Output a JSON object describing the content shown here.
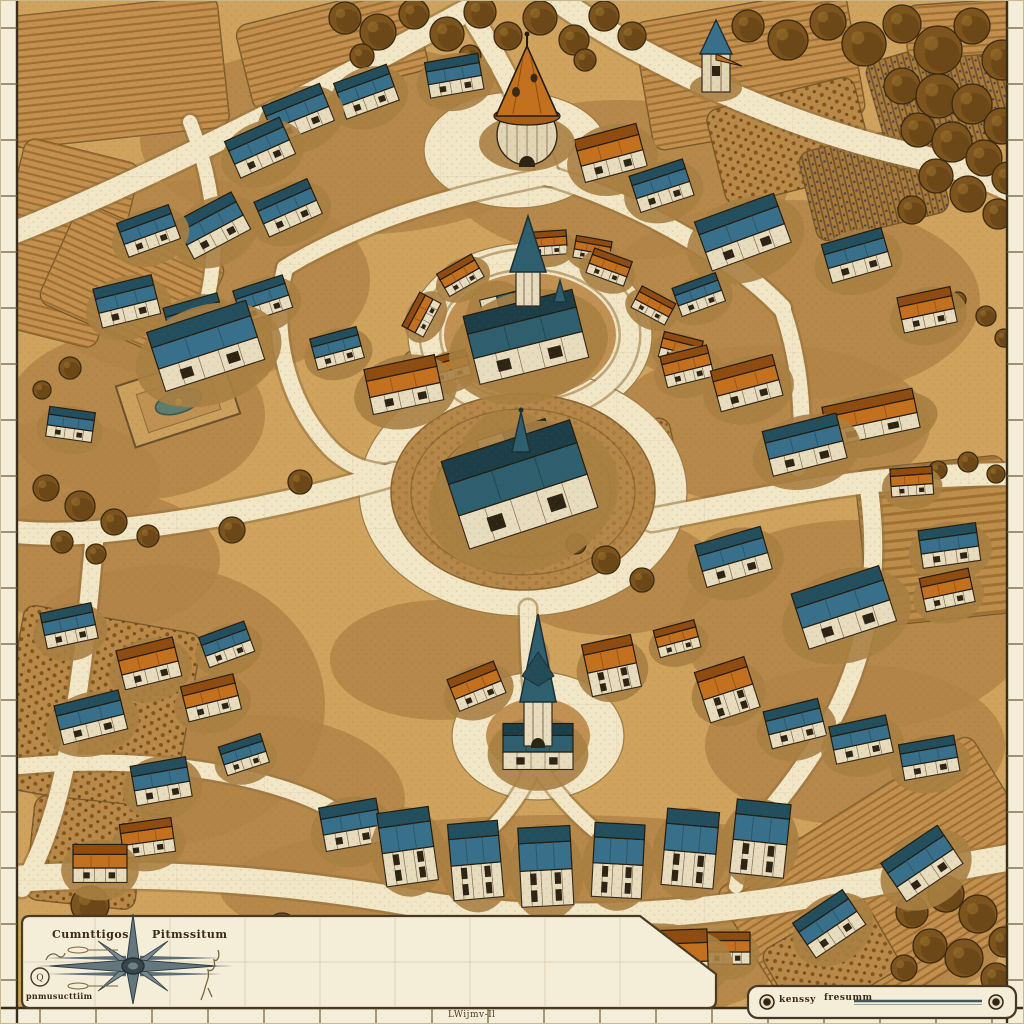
{
  "title": "hand-drawn isometric village map",
  "palette": {
    "parchment_road": "#f1e6c6",
    "ground": "#cfa35e",
    "scrub": "#b18446",
    "field_base": "#c49050",
    "margin_strip": "#f4edd8",
    "ink": "#33281a",
    "roof_blue": "#38708c",
    "roof_blue_dark": "#234e5e",
    "roof_teal": "#2e5f6f",
    "roof_orange": "#c4711f",
    "roof_orange_dark": "#8f4c10",
    "wall": "#e7dcbe",
    "tree": "#7d541d",
    "compass_steel": "#64777f"
  },
  "compass_panel": {
    "label_left": "Cumnttigos",
    "label_right": "Pitmssitum",
    "label_small": "pnmusucttiim",
    "badge": "Q"
  },
  "scale_panel": {
    "label_start": "kenssy",
    "label_mid": "fresumm"
  },
  "margins": {
    "bottom_label": "LWijmv-Il"
  },
  "scene": {
    "scrub": [
      [
        350,
        140,
        210,
        95
      ],
      [
        200,
        280,
        170,
        100
      ],
      [
        135,
        415,
        130,
        85
      ],
      [
        620,
        180,
        170,
        80
      ],
      [
        790,
        300,
        190,
        100
      ],
      [
        770,
        425,
        160,
        80
      ],
      [
        855,
        625,
        175,
        105
      ],
      [
        855,
        745,
        150,
        80
      ],
      [
        160,
        705,
        165,
        140
      ],
      [
        255,
        800,
        150,
        85
      ],
      [
        100,
        560,
        120,
        70
      ],
      [
        560,
        890,
        340,
        75
      ],
      [
        520,
        975,
        250,
        55
      ],
      [
        610,
        575,
        110,
        60
      ],
      [
        440,
        660,
        110,
        60
      ],
      [
        880,
        925,
        130,
        80
      ],
      [
        60,
        480,
        100,
        60
      ]
    ],
    "fields": [
      [
        6,
        6,
        218,
        132,
        -6,
        "furrow"
      ],
      [
        242,
        4,
        180,
        88,
        -14,
        "furrow"
      ],
      [
        2,
        148,
        118,
        190,
        14,
        "furrow"
      ],
      [
        52,
        228,
        160,
        110,
        24,
        "furrow"
      ],
      [
        642,
        4,
        215,
        130,
        -10,
        "furrow"
      ],
      [
        714,
        92,
        152,
        98,
        -14,
        "crops"
      ],
      [
        806,
        136,
        136,
        92,
        -14,
        "vine"
      ],
      [
        876,
        42,
        148,
        112,
        -16,
        "vine"
      ],
      [
        906,
        2,
        112,
        54,
        -4,
        "furrow"
      ],
      [
        862,
        462,
        150,
        158,
        -6,
        "rows"
      ],
      [
        742,
        798,
        300,
        190,
        -32,
        "furrow"
      ],
      [
        772,
        918,
        118,
        84,
        -30,
        "crops"
      ],
      [
        8,
        618,
        180,
        185,
        10,
        "crops"
      ],
      [
        30,
        800,
        110,
        105,
        6,
        "crops"
      ],
      [
        398,
        358,
        66,
        40,
        24,
        "red"
      ],
      [
        592,
        424,
        82,
        52,
        -12,
        "red"
      ]
    ],
    "plazas": [
      [
        516,
        150,
        92,
        58
      ],
      [
        530,
        335,
        122,
        92
      ],
      [
        523,
        492,
        164,
        124
      ],
      [
        538,
        736,
        86,
        64
      ]
    ],
    "inners": [
      [
        530,
        335,
        86,
        62
      ],
      [
        538,
        736,
        52,
        38
      ]
    ],
    "central_plaza": {
      "x": 523,
      "y": 492,
      "rx": 132,
      "ry": 98,
      "rings": [
        112,
        88,
        66
      ]
    },
    "roads": [
      [
        "M0,238 C120,192 300,102 468,10",
        22
      ],
      [
        "M468,10 C505,68 532,125 549,176",
        20
      ],
      [
        "M558,0 C652,66 790,128 915,156 C962,167 998,182 1024,196",
        24
      ],
      [
        "M549,176 C480,190 420,205 372,225 C340,238 310,252 285,268",
        16
      ],
      [
        "M549,176 C600,192 650,215 695,242 C730,262 760,285 782,308",
        18
      ],
      [
        "M285,268 C270,330 285,400 330,448 C352,470 374,472 394,474",
        16
      ],
      [
        "M531,254 C531,278 531,298 531,314",
        14
      ],
      [
        "M430,335 a100,76 0 1 0 200,0 a100,76 0 1 0 -200,0",
        18
      ],
      [
        "M531,410 L529,434",
        16
      ],
      [
        "M394,474 C300,502 200,522 95,532 C60,535 25,534 0,530",
        22
      ],
      [
        "M652,520 C730,505 800,490 868,482 C920,476 975,474 1024,474",
        22
      ],
      [
        "M528,608 C528,650 530,676 533,698",
        16
      ],
      [
        "M533,766 C520,800 495,830 462,852",
        14
      ],
      [
        "M538,766 C560,800 590,830 622,850",
        14
      ],
      [
        "M0,880 C150,868 300,882 420,904 C540,925 680,918 810,895 C890,880 970,864 1024,855",
        26
      ],
      [
        "M95,532 C88,610 82,690 62,780 C52,824 38,860 22,888",
        18
      ],
      [
        "M782,308 C800,360 806,420 798,468",
        16
      ],
      [
        "M868,482 C880,560 872,640 836,712 C815,754 788,790 762,820",
        18
      ],
      [
        "M762,820 C748,846 740,866 736,886",
        14
      ],
      [
        "M190,122 C218,192 222,262 198,332",
        14
      ],
      [
        "M0,768 C90,758 180,762 252,780 C300,792 332,806 354,824",
        16
      ]
    ],
    "trees": [
      [
        345,
        18,
        16
      ],
      [
        378,
        32,
        18
      ],
      [
        414,
        14,
        15
      ],
      [
        447,
        34,
        17
      ],
      [
        480,
        12,
        16
      ],
      [
        508,
        36,
        14
      ],
      [
        540,
        18,
        17
      ],
      [
        574,
        40,
        15
      ],
      [
        604,
        16,
        15
      ],
      [
        632,
        36,
        14
      ],
      [
        362,
        56,
        12
      ],
      [
        470,
        56,
        11
      ],
      [
        585,
        60,
        11
      ],
      [
        748,
        26,
        16
      ],
      [
        788,
        40,
        20
      ],
      [
        828,
        22,
        18
      ],
      [
        864,
        44,
        22
      ],
      [
        902,
        24,
        19
      ],
      [
        938,
        50,
        24
      ],
      [
        972,
        26,
        18
      ],
      [
        1002,
        60,
        20
      ],
      [
        902,
        86,
        18
      ],
      [
        938,
        96,
        22
      ],
      [
        972,
        104,
        20
      ],
      [
        1002,
        126,
        18
      ],
      [
        918,
        130,
        17
      ],
      [
        952,
        142,
        20
      ],
      [
        984,
        158,
        18
      ],
      [
        1008,
        178,
        16
      ],
      [
        936,
        176,
        17
      ],
      [
        968,
        194,
        18
      ],
      [
        998,
        214,
        15
      ],
      [
        912,
        210,
        14
      ],
      [
        986,
        316,
        10
      ],
      [
        1004,
        338,
        9
      ],
      [
        958,
        300,
        8
      ],
      [
        938,
        470,
        9
      ],
      [
        968,
        462,
        10
      ],
      [
        996,
        474,
        9
      ],
      [
        912,
        912,
        16
      ],
      [
        946,
        894,
        18
      ],
      [
        978,
        914,
        19
      ],
      [
        1004,
        942,
        15
      ],
      [
        930,
        946,
        17
      ],
      [
        964,
        958,
        19
      ],
      [
        996,
        978,
        15
      ],
      [
        904,
        968,
        13
      ],
      [
        232,
        530,
        13
      ],
      [
        300,
        482,
        12
      ],
      [
        90,
        905,
        19
      ],
      [
        282,
        928,
        15
      ],
      [
        606,
        560,
        14
      ],
      [
        642,
        580,
        12
      ],
      [
        576,
        544,
        10
      ],
      [
        46,
        488,
        13
      ],
      [
        80,
        506,
        15
      ],
      [
        114,
        522,
        13
      ],
      [
        148,
        536,
        11
      ],
      [
        62,
        542,
        11
      ],
      [
        96,
        554,
        10
      ],
      [
        70,
        368,
        11
      ],
      [
        42,
        390,
        9
      ]
    ],
    "houses": [
      [
        300,
        118,
        -22,
        62,
        40,
        "b",
        0
      ],
      [
        368,
        96,
        -20,
        56,
        38,
        "b",
        0
      ],
      [
        455,
        80,
        -10,
        54,
        36,
        "b",
        0
      ],
      [
        262,
        152,
        -24,
        60,
        40,
        "b",
        0
      ],
      [
        215,
        230,
        -28,
        64,
        42,
        "b",
        0
      ],
      [
        290,
        212,
        -24,
        58,
        38,
        "b",
        0
      ],
      [
        150,
        235,
        -20,
        55,
        36,
        "b",
        0
      ],
      [
        128,
        306,
        -14,
        60,
        40,
        "b",
        0
      ],
      [
        196,
        322,
        -16,
        56,
        36,
        "b",
        0
      ],
      [
        264,
        303,
        -18,
        52,
        34,
        "b",
        0
      ],
      [
        338,
        352,
        -15,
        48,
        32,
        "b",
        0
      ],
      [
        70,
        428,
        8,
        46,
        30,
        "b",
        0
      ],
      [
        405,
        390,
        -12,
        72,
        46,
        "o",
        0
      ],
      [
        612,
        158,
        -15,
        64,
        44,
        "o",
        0
      ],
      [
        663,
        190,
        -18,
        56,
        38,
        "b",
        0
      ],
      [
        745,
        238,
        -20,
        84,
        52,
        "b",
        0
      ],
      [
        858,
        260,
        -16,
        62,
        40,
        "b",
        0
      ],
      [
        700,
        298,
        -20,
        46,
        30,
        "b",
        0
      ],
      [
        928,
        314,
        -12,
        54,
        36,
        "o",
        0
      ],
      [
        462,
        278,
        -30,
        40,
        26,
        "o",
        0
      ],
      [
        424,
        316,
        -62,
        38,
        24,
        "o",
        0
      ],
      [
        450,
        370,
        -15,
        40,
        26,
        "o",
        0
      ],
      [
        608,
        270,
        20,
        40,
        26,
        "o",
        0
      ],
      [
        652,
        308,
        28,
        38,
        24,
        "o",
        0
      ],
      [
        680,
        352,
        14,
        40,
        26,
        "o",
        0
      ],
      [
        548,
        246,
        -4,
        38,
        24,
        "o",
        0
      ],
      [
        592,
        252,
        10,
        36,
        22,
        "o",
        0
      ],
      [
        748,
        388,
        -15,
        64,
        42,
        "o",
        0
      ],
      [
        688,
        370,
        -14,
        48,
        32,
        "o",
        0
      ],
      [
        872,
        422,
        -12,
        92,
        40,
        "o",
        0
      ],
      [
        912,
        485,
        -4,
        42,
        28,
        "o",
        0
      ],
      [
        806,
        450,
        -14,
        76,
        46,
        "b",
        0
      ],
      [
        950,
        550,
        -8,
        58,
        38,
        "b",
        0
      ],
      [
        948,
        594,
        -12,
        50,
        34,
        "o",
        0
      ],
      [
        735,
        562,
        -16,
        68,
        44,
        "b",
        0
      ],
      [
        846,
        614,
        -18,
        92,
        58,
        "b",
        0
      ],
      [
        728,
        692,
        -18,
        52,
        40,
        "o",
        1
      ],
      [
        796,
        728,
        -14,
        56,
        38,
        "b",
        0
      ],
      [
        862,
        744,
        -12,
        58,
        38,
        "b",
        0
      ],
      [
        930,
        762,
        -10,
        56,
        36,
        "b",
        0
      ],
      [
        925,
        868,
        -34,
        68,
        46,
        "b",
        0
      ],
      [
        832,
        928,
        -34,
        60,
        42,
        "b",
        0
      ],
      [
        352,
        830,
        -10,
        58,
        44,
        "b",
        0
      ],
      [
        408,
        850,
        -8,
        52,
        56,
        "b",
        1
      ],
      [
        476,
        864,
        -5,
        50,
        58,
        "b",
        1
      ],
      [
        546,
        870,
        -3,
        52,
        60,
        "b",
        1
      ],
      [
        618,
        864,
        3,
        50,
        56,
        "b",
        1
      ],
      [
        690,
        852,
        5,
        52,
        58,
        "b",
        1
      ],
      [
        760,
        842,
        6,
        54,
        56,
        "b",
        1
      ],
      [
        305,
        938,
        5,
        44,
        30,
        "o",
        0
      ],
      [
        392,
        968,
        -4,
        66,
        46,
        "o",
        0
      ],
      [
        462,
        984,
        0,
        52,
        38,
        "o",
        0
      ],
      [
        728,
        952,
        0,
        44,
        32,
        "o",
        0
      ],
      [
        100,
        868,
        0,
        54,
        38,
        "o",
        0
      ],
      [
        92,
        722,
        -14,
        66,
        40,
        "b",
        0
      ],
      [
        150,
        668,
        -14,
        58,
        40,
        "o",
        0
      ],
      [
        212,
        702,
        -14,
        54,
        36,
        "o",
        0
      ],
      [
        162,
        786,
        -10,
        56,
        40,
        "b",
        0
      ],
      [
        148,
        842,
        -8,
        52,
        34,
        "o",
        0
      ],
      [
        70,
        630,
        -12,
        52,
        36,
        "b",
        0
      ],
      [
        245,
        758,
        -18,
        44,
        30,
        "b",
        0
      ],
      [
        228,
        648,
        -20,
        48,
        32,
        "b",
        0
      ],
      [
        478,
        690,
        -22,
        50,
        34,
        "o",
        0
      ],
      [
        612,
        668,
        -12,
        50,
        40,
        "o",
        1
      ],
      [
        678,
        642,
        -15,
        42,
        28,
        "o",
        0
      ]
    ],
    "landmarks": {
      "round_tower": {
        "x": 527,
        "y": 135
      },
      "small_tower": {
        "x": 716,
        "y": 62
      },
      "north_church": {
        "x": 528,
        "y": 345
      },
      "central_hall": {
        "x": 523,
        "y": 495
      },
      "south_church": {
        "x": 538,
        "y": 720
      },
      "mansion": {
        "x": 208,
        "y": 353
      },
      "market_hall": {
        "x": 652,
        "y": 963
      }
    }
  }
}
